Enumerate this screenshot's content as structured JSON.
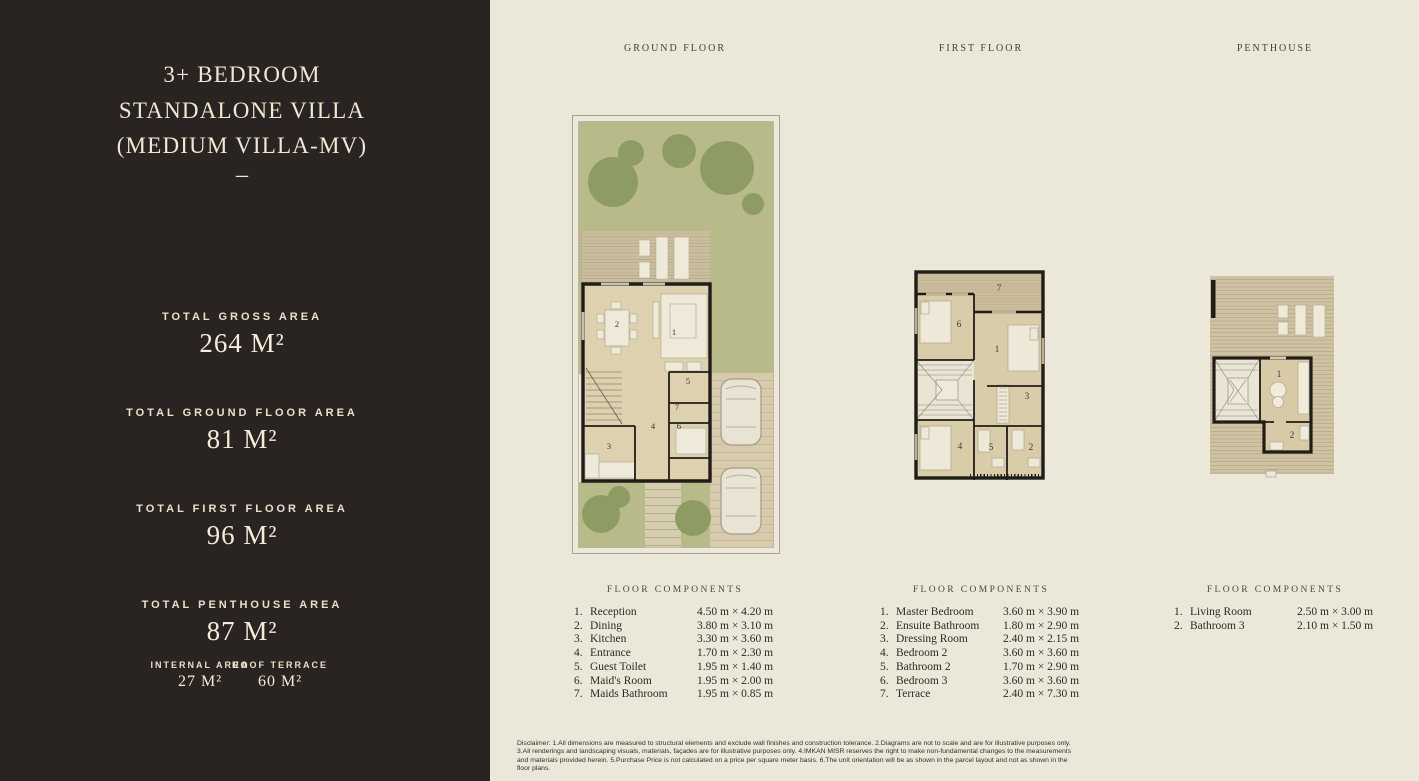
{
  "sidebar": {
    "title_line1": "3+ BEDROOM",
    "title_line2": "STANDALONE VILLA",
    "title_line3": "(MEDIUM VILLA-MV)",
    "dash": "–",
    "stats": [
      {
        "label": "TOTAL GROSS AREA",
        "value": "264 M²"
      },
      {
        "label": "TOTAL GROUND FLOOR AREA",
        "value": "81 M²"
      },
      {
        "label": "TOTAL FIRST FLOOR AREA",
        "value": "96 M²"
      },
      {
        "label": "TOTAL PENTHOUSE AREA",
        "value": "87 M²"
      }
    ],
    "substats": [
      {
        "label": "INTERNAL AREA",
        "value": "27 M²"
      },
      {
        "label": "ROOF TERRACE",
        "value": "60 M²"
      }
    ]
  },
  "floors": [
    {
      "title": "GROUND FLOOR",
      "components_title": "FLOOR COMPONENTS",
      "plan_numbers": [
        "1",
        "2",
        "3",
        "4",
        "5",
        "6",
        "7"
      ],
      "components": [
        {
          "num": "1.",
          "name": "Reception",
          "dims": "4.50 m × 4.20 m"
        },
        {
          "num": "2.",
          "name": "Dining",
          "dims": "3.80 m × 3.10 m"
        },
        {
          "num": "3.",
          "name": "Kitchen",
          "dims": "3.30 m × 3.60 m"
        },
        {
          "num": "4.",
          "name": "Entrance",
          "dims": "1.70 m × 2.30 m"
        },
        {
          "num": "5.",
          "name": "Guest Toilet",
          "dims": "1.95 m × 1.40 m"
        },
        {
          "num": "6.",
          "name": "Maid's Room",
          "dims": "1.95 m × 2.00 m"
        },
        {
          "num": "7.",
          "name": "Maids Bathroom",
          "dims": "1.95 m × 0.85 m"
        }
      ]
    },
    {
      "title": "FIRST FLOOR",
      "components_title": "FLOOR COMPONENTS",
      "plan_numbers": [
        "1",
        "2",
        "3",
        "4",
        "5",
        "6",
        "7"
      ],
      "components": [
        {
          "num": "1.",
          "name": "Master Bedroom",
          "dims": "3.60 m × 3.90 m"
        },
        {
          "num": "2.",
          "name": "Ensuite Bathroom",
          "dims": "1.80 m × 2.90 m"
        },
        {
          "num": "3.",
          "name": "Dressing Room",
          "dims": "2.40 m × 2.15 m"
        },
        {
          "num": "4.",
          "name": "Bedroom 2",
          "dims": "3.60 m × 3.60 m"
        },
        {
          "num": "5.",
          "name": "Bathroom 2",
          "dims": "1.70 m × 2.90 m"
        },
        {
          "num": "6.",
          "name": "Bedroom 3",
          "dims": "3.60 m × 3.60 m"
        },
        {
          "num": "7.",
          "name": "Terrace",
          "dims": "2.40 m × 7.30 m"
        }
      ]
    },
    {
      "title": "PENTHOUSE",
      "components_title": "FLOOR COMPONENTS",
      "plan_numbers": [
        "1",
        "2"
      ],
      "components": [
        {
          "num": "1.",
          "name": "Living Room",
          "dims": "2.50 m × 3.00 m"
        },
        {
          "num": "2.",
          "name": "Bathroom 3",
          "dims": "2.10 m × 1.50 m"
        }
      ]
    }
  ],
  "disclaimer": "Disclaimer: 1.All dimensions are measured to structural elements and exclude wall finishes and construction tolerance. 2.Diagrams are not to scale and are for illustrative purposes only. 3.All renderings and landscaping visuals, materials, façades are for illustrative purposes only. 4.IMKAN MISR reserves the right to make non-fundamental changes to the measurements and materials provided herein. 5.Purchase Price is not calculated on a price per square meter basis. 6.The unit orientation will be as shown in the parcel layout and not as shown in the floor plans.",
  "colors": {
    "sidebar_bg": "#292322",
    "page_bg": "#ebe7d9",
    "cream_text": "#efe8d3",
    "dark_text": "#2e2a23",
    "garden_green": "#b8bb89",
    "tree_green": "#8e9c64",
    "room_floor": "#ddd1af",
    "deck_tan": "#cbbd9c",
    "wall_black": "#201d19",
    "driveway_tan": "#d8caad"
  }
}
